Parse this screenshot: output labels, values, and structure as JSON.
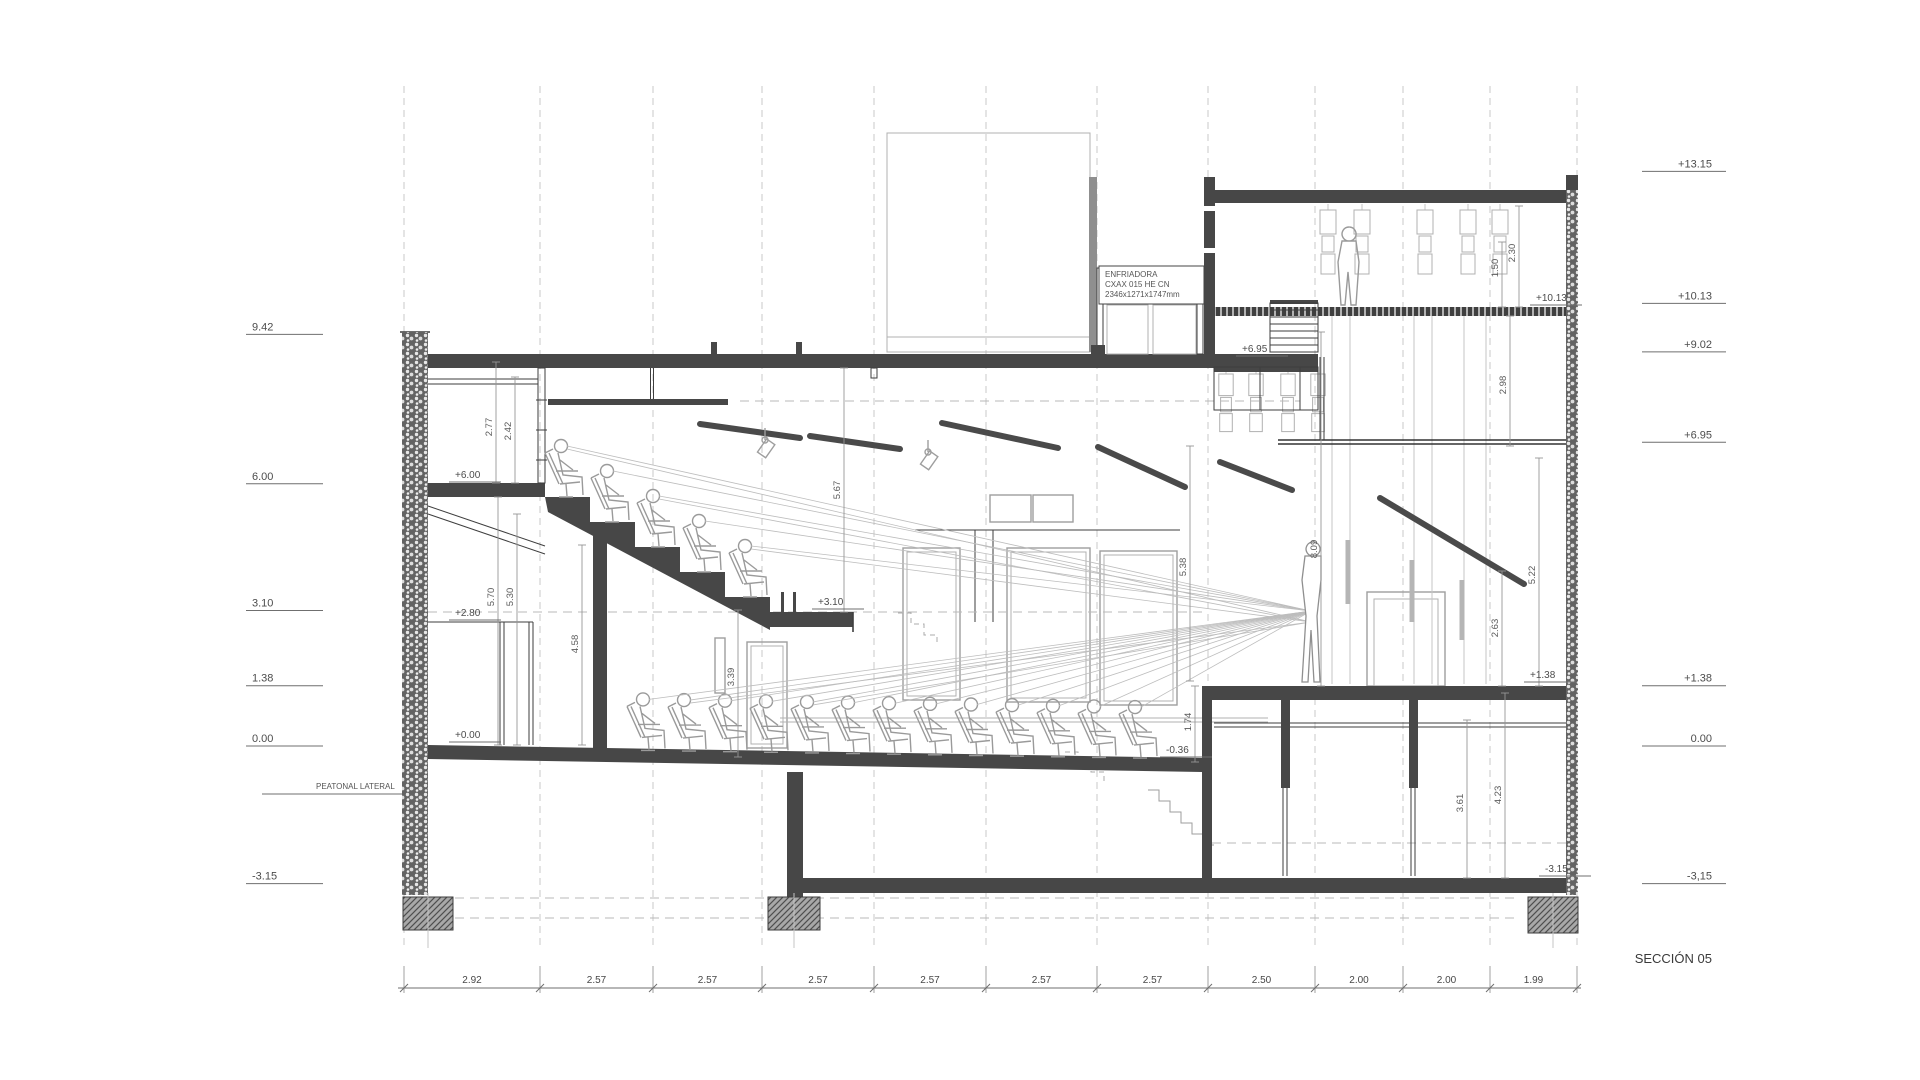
{
  "title": "SECCIÓN 05",
  "scale": {
    "px_per_m": 43.7,
    "y_zero": 740
  },
  "left_levels": [
    {
      "label": "9.42",
      "value": 9.42
    },
    {
      "label": "6.00",
      "value": 6.0
    },
    {
      "label": "3.10",
      "value": 3.1
    },
    {
      "label": "1.38",
      "value": 1.38
    },
    {
      "label": "0.00",
      "value": 0.0
    },
    {
      "label": "-3.15",
      "value": -3.15
    }
  ],
  "right_levels": [
    {
      "label": "+13.15",
      "value": 13.15
    },
    {
      "label": "+10.13",
      "value": 10.13
    },
    {
      "label": "+9.02",
      "value": 9.02
    },
    {
      "label": "+6.95",
      "value": 6.95
    },
    {
      "label": "+1.38",
      "value": 1.38
    },
    {
      "label": "0.00",
      "value": 0.0
    },
    {
      "label": "-3,15",
      "value": -3.15
    }
  ],
  "interior_levels": [
    {
      "label": "+6.00",
      "x": 455,
      "y": 478
    },
    {
      "label": "+2.80",
      "x": 455,
      "y": 616
    },
    {
      "label": "+0.00",
      "x": 455,
      "y": 738
    },
    {
      "label": "+3.10",
      "x": 818,
      "y": 605
    },
    {
      "label": "-0.36",
      "x": 1166,
      "y": 753
    },
    {
      "label": "+6.95",
      "x": 1242,
      "y": 352
    },
    {
      "label": "+1.38",
      "x": 1530,
      "y": 678
    },
    {
      "label": "+10.13",
      "x": 1536,
      "y": 301
    },
    {
      "label": "-3.15",
      "x": 1545,
      "y": 872
    }
  ],
  "vertical_dims": [
    {
      "label": "2.77",
      "x": 492,
      "y": 427,
      "x_line": 496,
      "y1": 362,
      "y2": 483
    },
    {
      "label": "2.42",
      "x": 511,
      "y": 431,
      "x_line": 515,
      "y1": 377,
      "y2": 483
    },
    {
      "label": "5.70",
      "x": 494,
      "y": 597,
      "x_line": 498,
      "y1": 497,
      "y2": 745
    },
    {
      "label": "5.30",
      "x": 513,
      "y": 597,
      "x_line": 517,
      "y1": 514,
      "y2": 745
    },
    {
      "label": "4.58",
      "x": 578,
      "y": 644,
      "x_line": 582,
      "y1": 545,
      "y2": 745
    },
    {
      "label": "3.39",
      "x": 734,
      "y": 677,
      "x_line": 738,
      "y1": 610,
      "y2": 757
    },
    {
      "label": "5.67",
      "x": 840,
      "y": 490,
      "x_line": 844,
      "y1": 368,
      "y2": 612
    },
    {
      "label": "5.38",
      "x": 1186,
      "y": 567,
      "x_line": 1190,
      "y1": 446,
      "y2": 681
    },
    {
      "label": "8.09",
      "x": 1317,
      "y": 549,
      "x_line": 1321,
      "y1": 332,
      "y2": 686
    },
    {
      "label": "1.74",
      "x": 1191,
      "y": 722,
      "x_line": 1195,
      "y1": 686,
      "y2": 762
    },
    {
      "label": "2.98",
      "x": 1506,
      "y": 385,
      "x_line": 1510,
      "y1": 316,
      "y2": 446
    },
    {
      "label": "1.50",
      "x": 1498,
      "y": 268,
      "x_line": 1502,
      "y1": 242,
      "y2": 307
    },
    {
      "label": "2.30",
      "x": 1515,
      "y": 253,
      "x_line": 1519,
      "y1": 206,
      "y2": 307
    },
    {
      "label": "5.22",
      "x": 1535,
      "y": 575,
      "x_line": 1539,
      "y1": 458,
      "y2": 686
    },
    {
      "label": "2.63",
      "x": 1498,
      "y": 628,
      "x_line": 1502,
      "y1": 571,
      "y2": 686
    },
    {
      "label": "3.61",
      "x": 1463,
      "y": 803,
      "x_line": 1467,
      "y1": 720,
      "y2": 878
    },
    {
      "label": "4.23",
      "x": 1501,
      "y": 795,
      "x_line": 1505,
      "y1": 693,
      "y2": 878
    }
  ],
  "bottom_dims": {
    "ticks": [
      404,
      540,
      653,
      762,
      874,
      986,
      1097,
      1208,
      1315,
      1403,
      1490,
      1577
    ],
    "labels": [
      "2.92",
      "2.57",
      "2.57",
      "2.57",
      "2.57",
      "2.57",
      "2.57",
      "2.50",
      "2.00",
      "2.00",
      "1.99"
    ],
    "line_y": 988
  },
  "annotations": {
    "peatonal": "PEATONAL LATERAL",
    "enfriadora_line1": "ENFRIADORA",
    "enfriadora_line2": "CXAX 015 HE CN",
    "enfriadora_line3": "2346x1271x1747mm"
  },
  "colors": {
    "cut_gray": "#474747",
    "beyond_gray": "#9e9e9e",
    "accent_teal": "#2ec4b6"
  }
}
